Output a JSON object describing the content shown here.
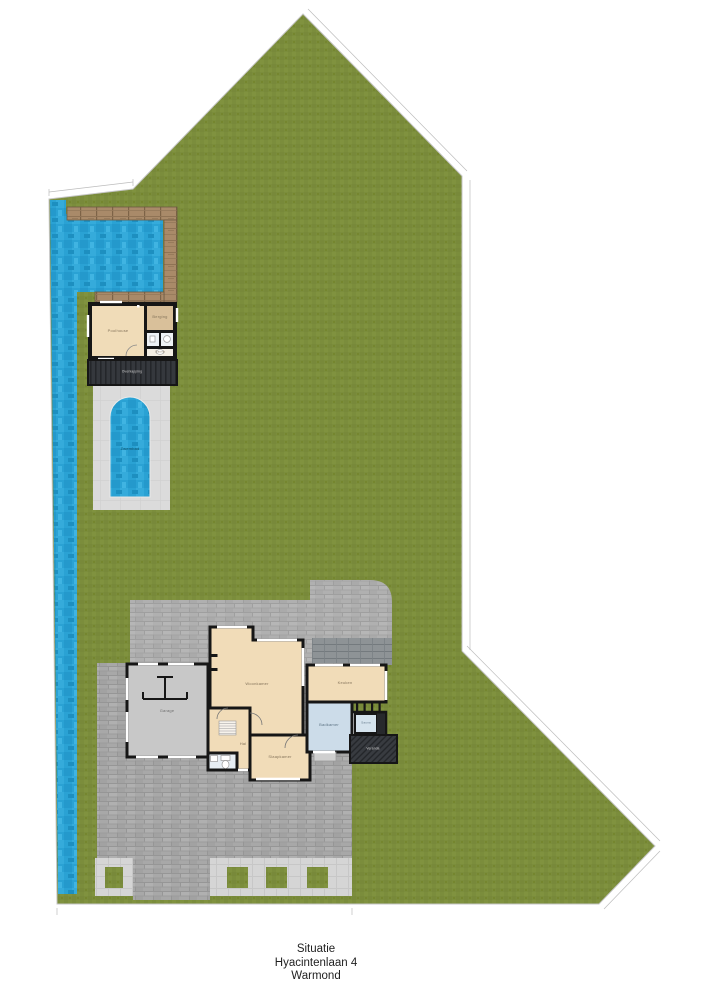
{
  "caption": {
    "lines": [
      "Situatie",
      "Hyacintenlaan 4",
      "Warmond"
    ]
  },
  "rooms": {
    "pool": "Zwembad",
    "poolhouse": "Poolhouse",
    "storage": "Berging",
    "sauna_small": "Sauna",
    "canopy": "Overkapping",
    "garage": "Garage",
    "living": "Woonkamer",
    "hall": "Hal",
    "bedroom": "Slaapkamer",
    "kitchen": "Keuken",
    "bathroom": "Badkamer",
    "sauna_house": "Sauna",
    "veranda": "Veranda"
  },
  "colors": {
    "lawn": "#7b8d3c",
    "water": "#2aa2d4",
    "deck_wood": "#a98a69",
    "paving": "#a8a8a8",
    "patio": "#dbdbdb",
    "room_tan": "#f1dcb8",
    "room_blue": "#ccdce9",
    "garage_floor": "#c8c8c8",
    "walls": "#161616",
    "veranda_dark": "#35383d",
    "boundary": "#c6c6c6"
  }
}
